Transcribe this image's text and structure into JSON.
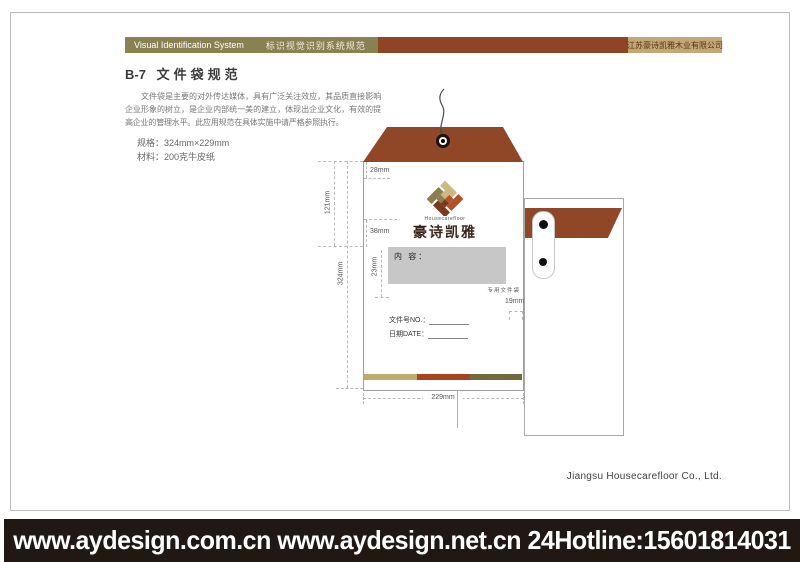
{
  "header": {
    "en_title": "Visual Identification System",
    "cn_title": "标识视觉识别系统规范",
    "company": "江苏豪诗凯雅木业有限公司"
  },
  "page": {
    "code": "B-7",
    "title": "文件袋规范",
    "intro": "文件袋是主要的对外传达媒体，具有广泛关注效应，其品质直接影响企业形象的树立，是企业内部统一美的建立，体现出企业文化，有效的提高企业的管理水平。此应用规范在具体实施中请严格参照执行。",
    "spec": "规格：324mm×229mm",
    "material": "材料：200克牛皮纸"
  },
  "envelope": {
    "brand_en": "Housecarefloor",
    "brand_cn": "豪诗凯雅",
    "content_label": "内 容：",
    "special_label": "专用文件袋",
    "file_no": "文件号NO.：",
    "date": "日期DATE：",
    "dims": {
      "d28": "28mm",
      "d38": "38mm",
      "d121": "121mm",
      "d324": "324mm",
      "d23": "23mm",
      "d19": "19mm",
      "d229": "229mm"
    }
  },
  "footer": {
    "company_en": "Jiangsu Housecarefloor Co., Ltd.",
    "banner": "www.aydesign.com.cn www.aydesign.net.cn 24Hotline:15601814031"
  },
  "colors": {
    "olive_bar": "#8a8152",
    "brown_bar": "#8e4526",
    "tan_badge": "#c0a878",
    "flap_brown": "#8f4728",
    "stripe_tan": "#c2a96d",
    "stripe_rust": "#a8441f",
    "stripe_olive": "#6f693c",
    "banner_bg": "#221813",
    "logo_tan": "#cdb87f",
    "logo_rust": "#b35127",
    "logo_olive": "#8c7e4e",
    "logo_darkbrown": "#7a3a1d"
  }
}
